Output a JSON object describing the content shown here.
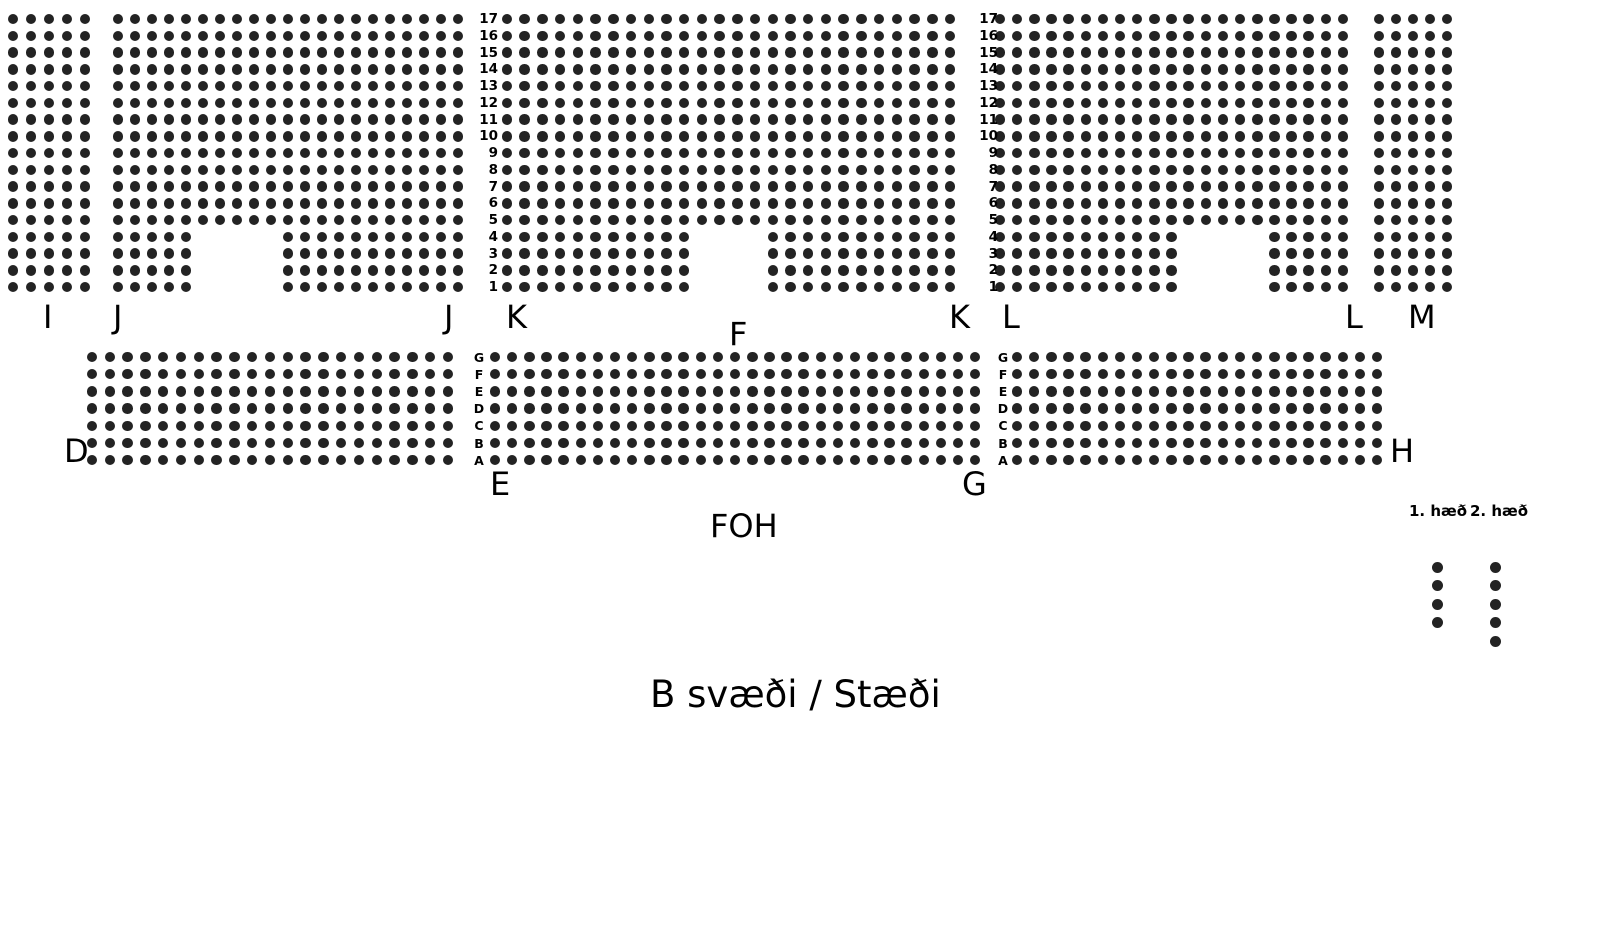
{
  "title": "B svæði / Stæði",
  "foh_label": "FOH",
  "colors": {
    "seat": "#232323",
    "text": "#000000",
    "background": "#ffffff"
  },
  "seat_dot": {
    "diameter": 10.5
  },
  "upper": {
    "row_count": 17,
    "row_numbers": [
      "17",
      "16",
      "15",
      "14",
      "13",
      "12",
      "11",
      "10",
      "9",
      "8",
      "7",
      "6",
      "5",
      "4",
      "3",
      "2",
      "1"
    ],
    "y0": 19,
    "pitch_y": 16.75,
    "blocks": [
      {
        "name": "I",
        "x0": 13,
        "cols": 5,
        "pitch_x": 18.0,
        "notch": null
      },
      {
        "name": "J",
        "x0": 118,
        "cols": 21,
        "pitch_x": 17.0,
        "notch": {
          "bottom_rows": 4,
          "skip_from": 6,
          "skip_to": 10
        }
      },
      {
        "name": "K",
        "x0": 507,
        "cols": 26,
        "pitch_x": 17.72,
        "notch": {
          "bottom_rows": 4,
          "skip_from": 12,
          "skip_to": 15
        }
      },
      {
        "name": "L",
        "x0": 1000,
        "cols": 21,
        "pitch_x": 17.15,
        "notch": {
          "bottom_rows": 4,
          "skip_from": 12,
          "skip_to": 16
        }
      },
      {
        "name": "M",
        "x0": 1379,
        "cols": 5,
        "pitch_x": 17.0,
        "notch": null
      }
    ],
    "number_columns": [
      {
        "right_x": 498
      },
      {
        "right_x": 998
      }
    ]
  },
  "middle": {
    "row_letters": [
      "G",
      "F",
      "E",
      "D",
      "C",
      "B",
      "A"
    ],
    "y0": 357,
    "pitch_y": 17.2,
    "blocks": [
      {
        "name": "D",
        "x0": 92,
        "cols": 21,
        "pitch_x": 17.8
      },
      {
        "name": "EFG",
        "x0": 495,
        "cols": 29,
        "pitch_x": 17.15
      },
      {
        "name": "H",
        "x0": 1017,
        "cols": 22,
        "pitch_x": 17.15
      }
    ],
    "letter_columns": [
      {
        "center_x": 479
      },
      {
        "center_x": 1003
      }
    ]
  },
  "section_labels": [
    {
      "id": "i",
      "text": "I",
      "x": 43,
      "y": 301
    },
    {
      "id": "j-left",
      "text": "J",
      "x": 113,
      "y": 301
    },
    {
      "id": "j-right",
      "text": "J",
      "x": 444,
      "y": 301
    },
    {
      "id": "k-left",
      "text": "K",
      "x": 506,
      "y": 301
    },
    {
      "id": "f",
      "text": "F",
      "x": 729,
      "y": 318
    },
    {
      "id": "k-right",
      "text": "K",
      "x": 949,
      "y": 301
    },
    {
      "id": "l-left",
      "text": "L",
      "x": 1002,
      "y": 301
    },
    {
      "id": "l-right",
      "text": "L",
      "x": 1345,
      "y": 301
    },
    {
      "id": "m",
      "text": "M",
      "x": 1408,
      "y": 301
    },
    {
      "id": "d",
      "text": "D",
      "x": 64,
      "y": 435
    },
    {
      "id": "e",
      "text": "E",
      "x": 490,
      "y": 468
    },
    {
      "id": "g",
      "text": "G",
      "x": 962,
      "y": 468
    },
    {
      "id": "h",
      "text": "H",
      "x": 1390,
      "y": 435
    }
  ],
  "foh": {
    "x": 710,
    "y": 510
  },
  "title_pos": {
    "x": 650,
    "y": 675
  },
  "legend": {
    "label_y": 503,
    "dots_y0": 567,
    "dot_pitch": 18.5,
    "dot_diameter": 11,
    "items": [
      {
        "label": "1. hæð",
        "label_x": 1409,
        "dots_x": 1437,
        "dots": 4
      },
      {
        "label": "2. hæð",
        "label_x": 1470,
        "dots_x": 1495,
        "dots": 5
      }
    ]
  }
}
